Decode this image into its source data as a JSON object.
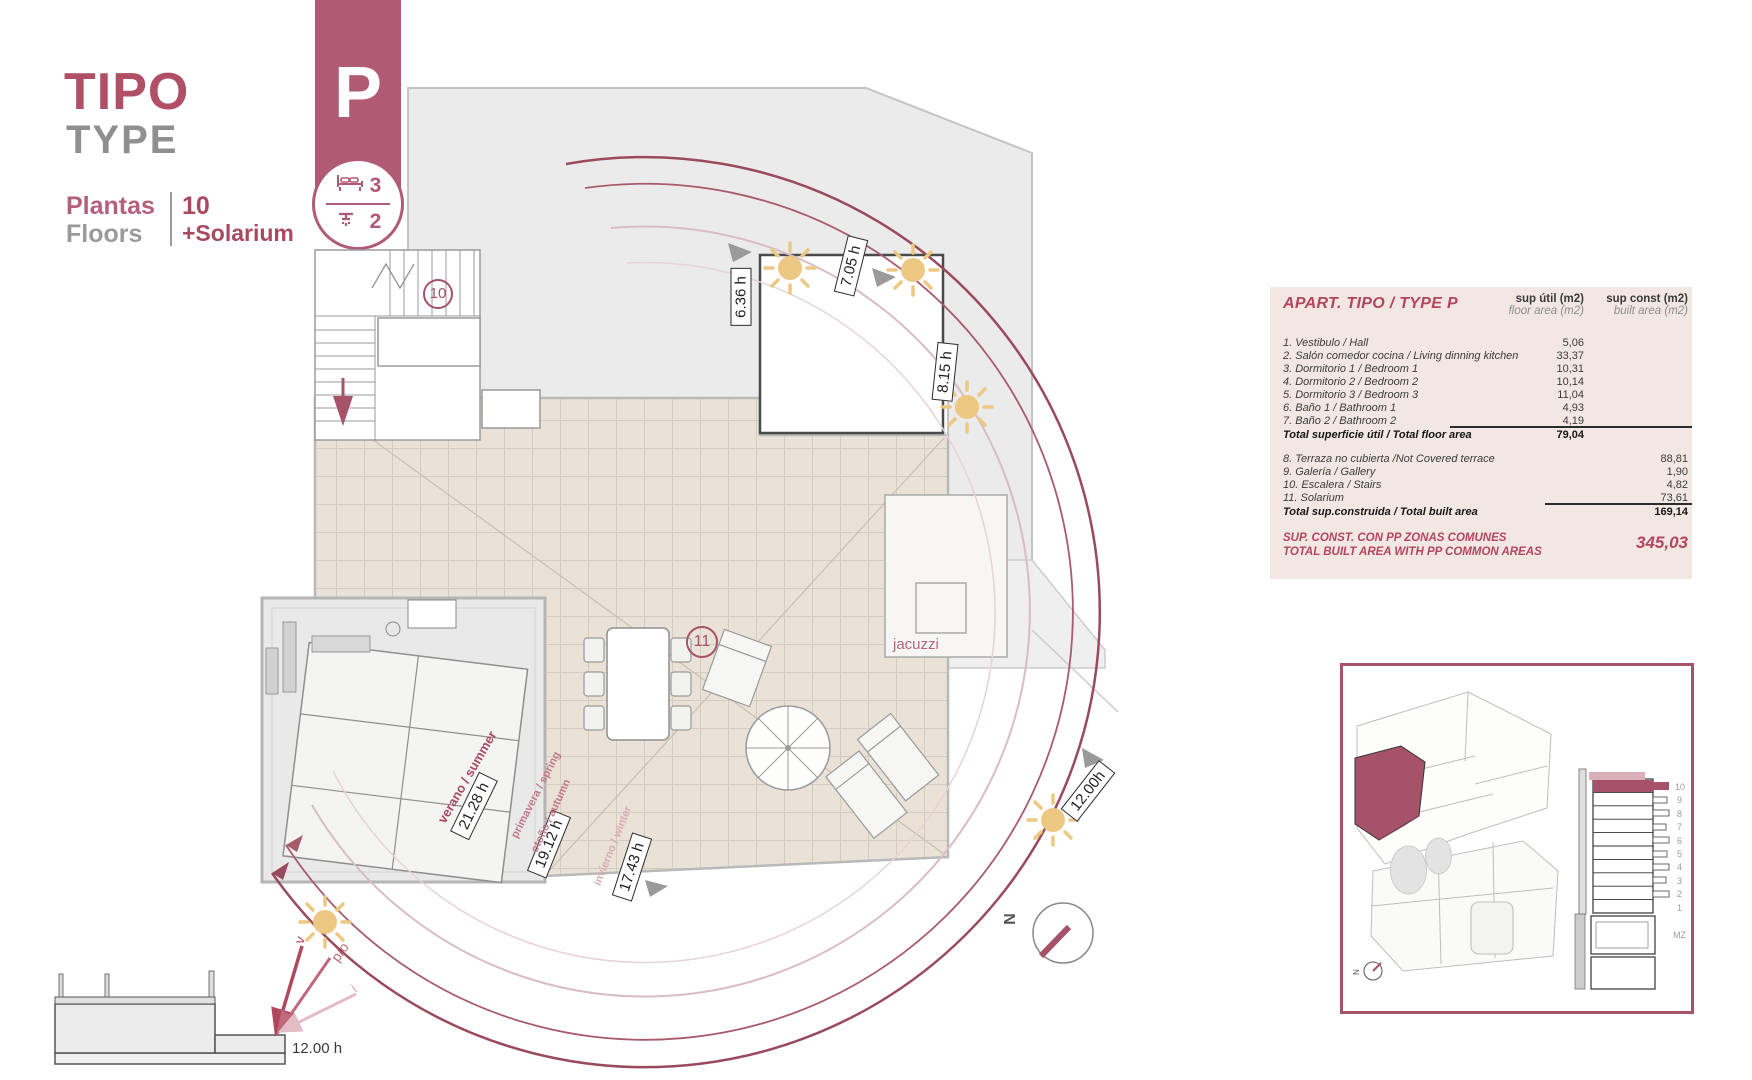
{
  "header": {
    "tipo": "TIPO",
    "type": "TYPE",
    "plantas_label": "Plantas",
    "floors_label": "Floors",
    "floors_value": "10",
    "solarium_value": "+Solarium"
  },
  "badge": {
    "letter": "P",
    "bedrooms": "3",
    "bathrooms": "2"
  },
  "plan": {
    "room_numbers": {
      "stairs": "10",
      "solarium": "11"
    },
    "jacuzzi_label": "jacuzzi",
    "sun_hours": {
      "h1": "6.36 h",
      "h2": "7.05 h",
      "h3": "8.15 h",
      "h4": "12.00h",
      "h5": "21.28 h",
      "h6": "19.12 h",
      "h7": "17.43 h"
    },
    "seasons": {
      "summer": "verano / summer",
      "spring": "primavera / spring",
      "autumn": "otoño / autumn",
      "winter": "invierno / winter"
    },
    "section_time": "12.00 h",
    "sun_arrows": {
      "v": "v",
      "po": "p/o",
      "i": "i"
    },
    "compass_n": "N"
  },
  "table": {
    "title": "APART. TIPO / TYPE P",
    "col1_header_line1": "sup útil (m2)",
    "col1_header_line2": "floor area (m2)",
    "col2_header_line1": "sup const  (m2)",
    "col2_header_line2": "built area (m2)",
    "rows": [
      {
        "label": "1. Vestibulo / Hall",
        "floor": "5,06"
      },
      {
        "label": "2. Salón comedor cocina / Living dinning kitchen",
        "floor": "33,37"
      },
      {
        "label": "3. Dormitorio 1 / Bedroom 1",
        "floor": "10,31"
      },
      {
        "label": "4. Dormitorio 2 / Bedroom 2",
        "floor": "10,14"
      },
      {
        "label": "5. Dormitorio 3 / Bedroom 3",
        "floor": "11,04"
      },
      {
        "label": "6. Baño 1 / Bathroom 1",
        "floor": "4,93"
      },
      {
        "label": "7. Baño 2 / Bathroom 2",
        "floor": "4,19"
      }
    ],
    "total_floor": {
      "label": "Total superficie útil / Total floor area",
      "value": "79,04"
    },
    "rows_built": [
      {
        "label": "8. Terraza no cubierta /Not Covered terrace",
        "built": "88,81"
      },
      {
        "label": "9. Galería / Gallery",
        "built": "1,90"
      },
      {
        "label": "10. Escalera / Stairs",
        "built": "4,82"
      },
      {
        "label": "11. Solarium",
        "built": "73,61"
      }
    ],
    "total_built": {
      "label": "Total sup.construida / Total built area",
      "value": "169,14"
    },
    "summary": {
      "line1": "SUP. CONST. CON PP ZONAS COMUNES",
      "line2": "TOTAL BUILT AREA WITH PP COMMON AREAS",
      "value": "345,03"
    }
  },
  "inset": {
    "floor_labels": [
      "10",
      "9",
      "8",
      "7",
      "6",
      "5",
      "4",
      "3",
      "2",
      "1",
      "MZ"
    ],
    "compass_n": "N"
  },
  "colors": {
    "accent": "#b04f66",
    "badge": "#b05a73",
    "arc_dark": "#9a4a5c",
    "arc_light": "#d9bcc4",
    "sun": "#ecc883",
    "table_bg": "#f2e7e2"
  }
}
